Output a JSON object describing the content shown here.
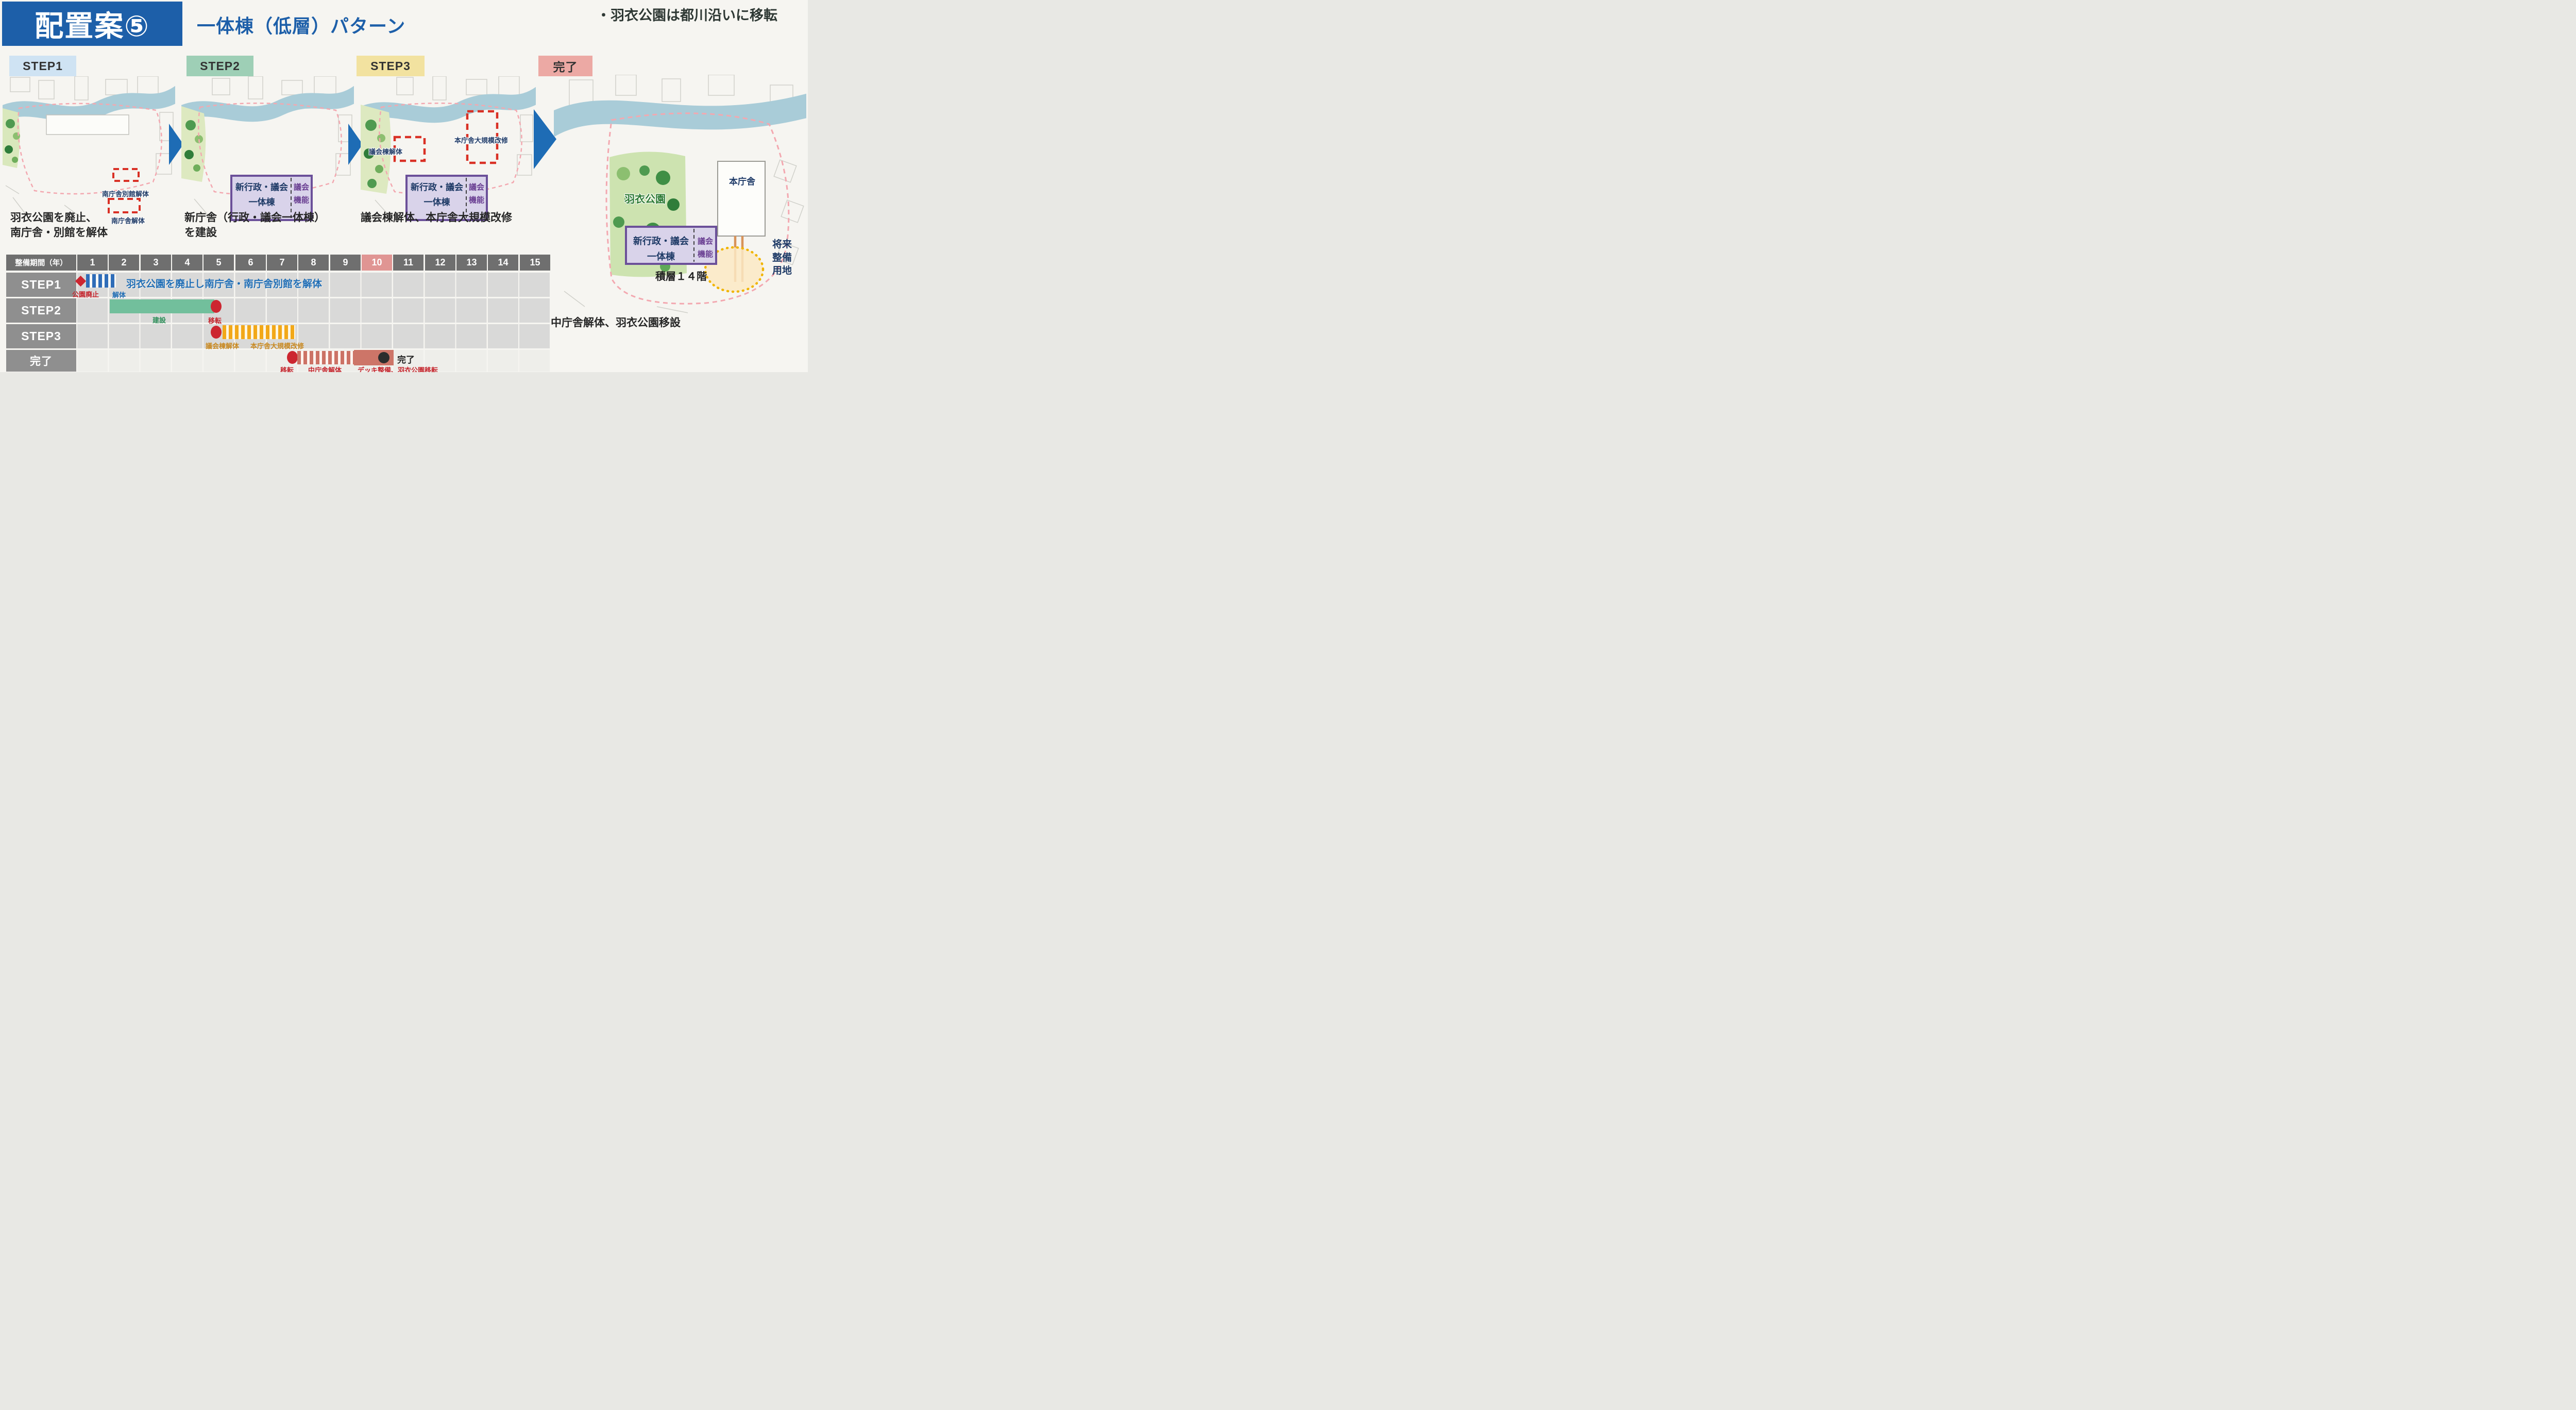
{
  "header": {
    "badge": "配置案⑤",
    "subtitle": "一体棟（低層）パターン",
    "note": "・羽衣公園は都川沿いに移転"
  },
  "steps": {
    "step1": {
      "chip": "STEP1",
      "caption1": "羽衣公園を廃止、",
      "caption2": "南庁舎・別館を解体",
      "annex_label": "南庁舎別館解体",
      "south_label": "南庁舎解体"
    },
    "step2": {
      "chip": "STEP2",
      "caption1": "新庁舎（行政・議会一体棟）",
      "caption2": "を建設"
    },
    "step3": {
      "chip": "STEP3",
      "caption": "議会棟解体、本庁舎大規模改修",
      "council_demolition_label": "議会棟解体",
      "main_renovation_label": "本庁舎大規模改修"
    },
    "done": {
      "chip": "完了",
      "caption": "中庁舎解体、羽衣公園移設",
      "park_label": "羽衣公園",
      "main_building_label": "本庁舎",
      "future_site_line1": "将来",
      "future_site_line2": "整備",
      "future_site_line3": "用地",
      "floors_label": "積層１４階"
    }
  },
  "building_box": {
    "line1": "新行政・議会",
    "line2": "一体棟",
    "right_line1": "議会",
    "right_line2": "機能"
  },
  "colors": {
    "accent_blue": "#1d5fa9",
    "step1_chip": "#cfe3f3",
    "step2_chip": "#9ecfb6",
    "step3_chip": "#f2e2a0",
    "done_chip": "#eca9a4",
    "river": "#a9ccd8",
    "park": "#d9e8bc",
    "purple_box_fill": "#d9d3ea",
    "purple_box_border": "#6b5099",
    "demolition_red": "#d93025",
    "highlight_year_cell": "#e09593"
  },
  "gantt": {
    "period_label": "整備期間（年）",
    "years": [
      "1",
      "2",
      "3",
      "4",
      "5",
      "6",
      "7",
      "8",
      "9",
      "10",
      "11",
      "12",
      "13",
      "14",
      "15"
    ],
    "highlighted_year": "10",
    "rows": {
      "step1": {
        "label": "STEP1",
        "milestone_label": "公園廃止",
        "bar_label": "解体",
        "annotation": "羽衣公園を廃止し南庁舎・南庁舎別館を解体",
        "milestone_year": 1,
        "bar_start_year": 1,
        "bar_end_year": 2.2,
        "bar_style": "hatched-blue"
      },
      "step2": {
        "label": "STEP2",
        "bar_label": "建設",
        "end_label": "移転",
        "bar_start_year": 2,
        "bar_end_year": 5.3,
        "bar_style": "solid-green"
      },
      "step3": {
        "label": "STEP3",
        "bar_label1": "議会棟解体",
        "bar_label2": "本庁舎大規模改修",
        "start_marker_year": 5.4,
        "bar_start_year": 5.6,
        "bar_end_year": 7.9,
        "bar_style": "hatched-orange"
      },
      "done": {
        "label": "完了",
        "start_label": "移転",
        "bar_label1": "中庁舎解体",
        "bar_label2": "デッキ整備、羽衣公園移転",
        "end_label": "完了",
        "bar1_start_year": 8,
        "bar1_end_year": 9.7,
        "bar2_start_year": 9.7,
        "bar2_end_year": 11,
        "end_marker_year": 10.7,
        "bar_style": "hatched-salmon,solid-salmon"
      }
    }
  }
}
